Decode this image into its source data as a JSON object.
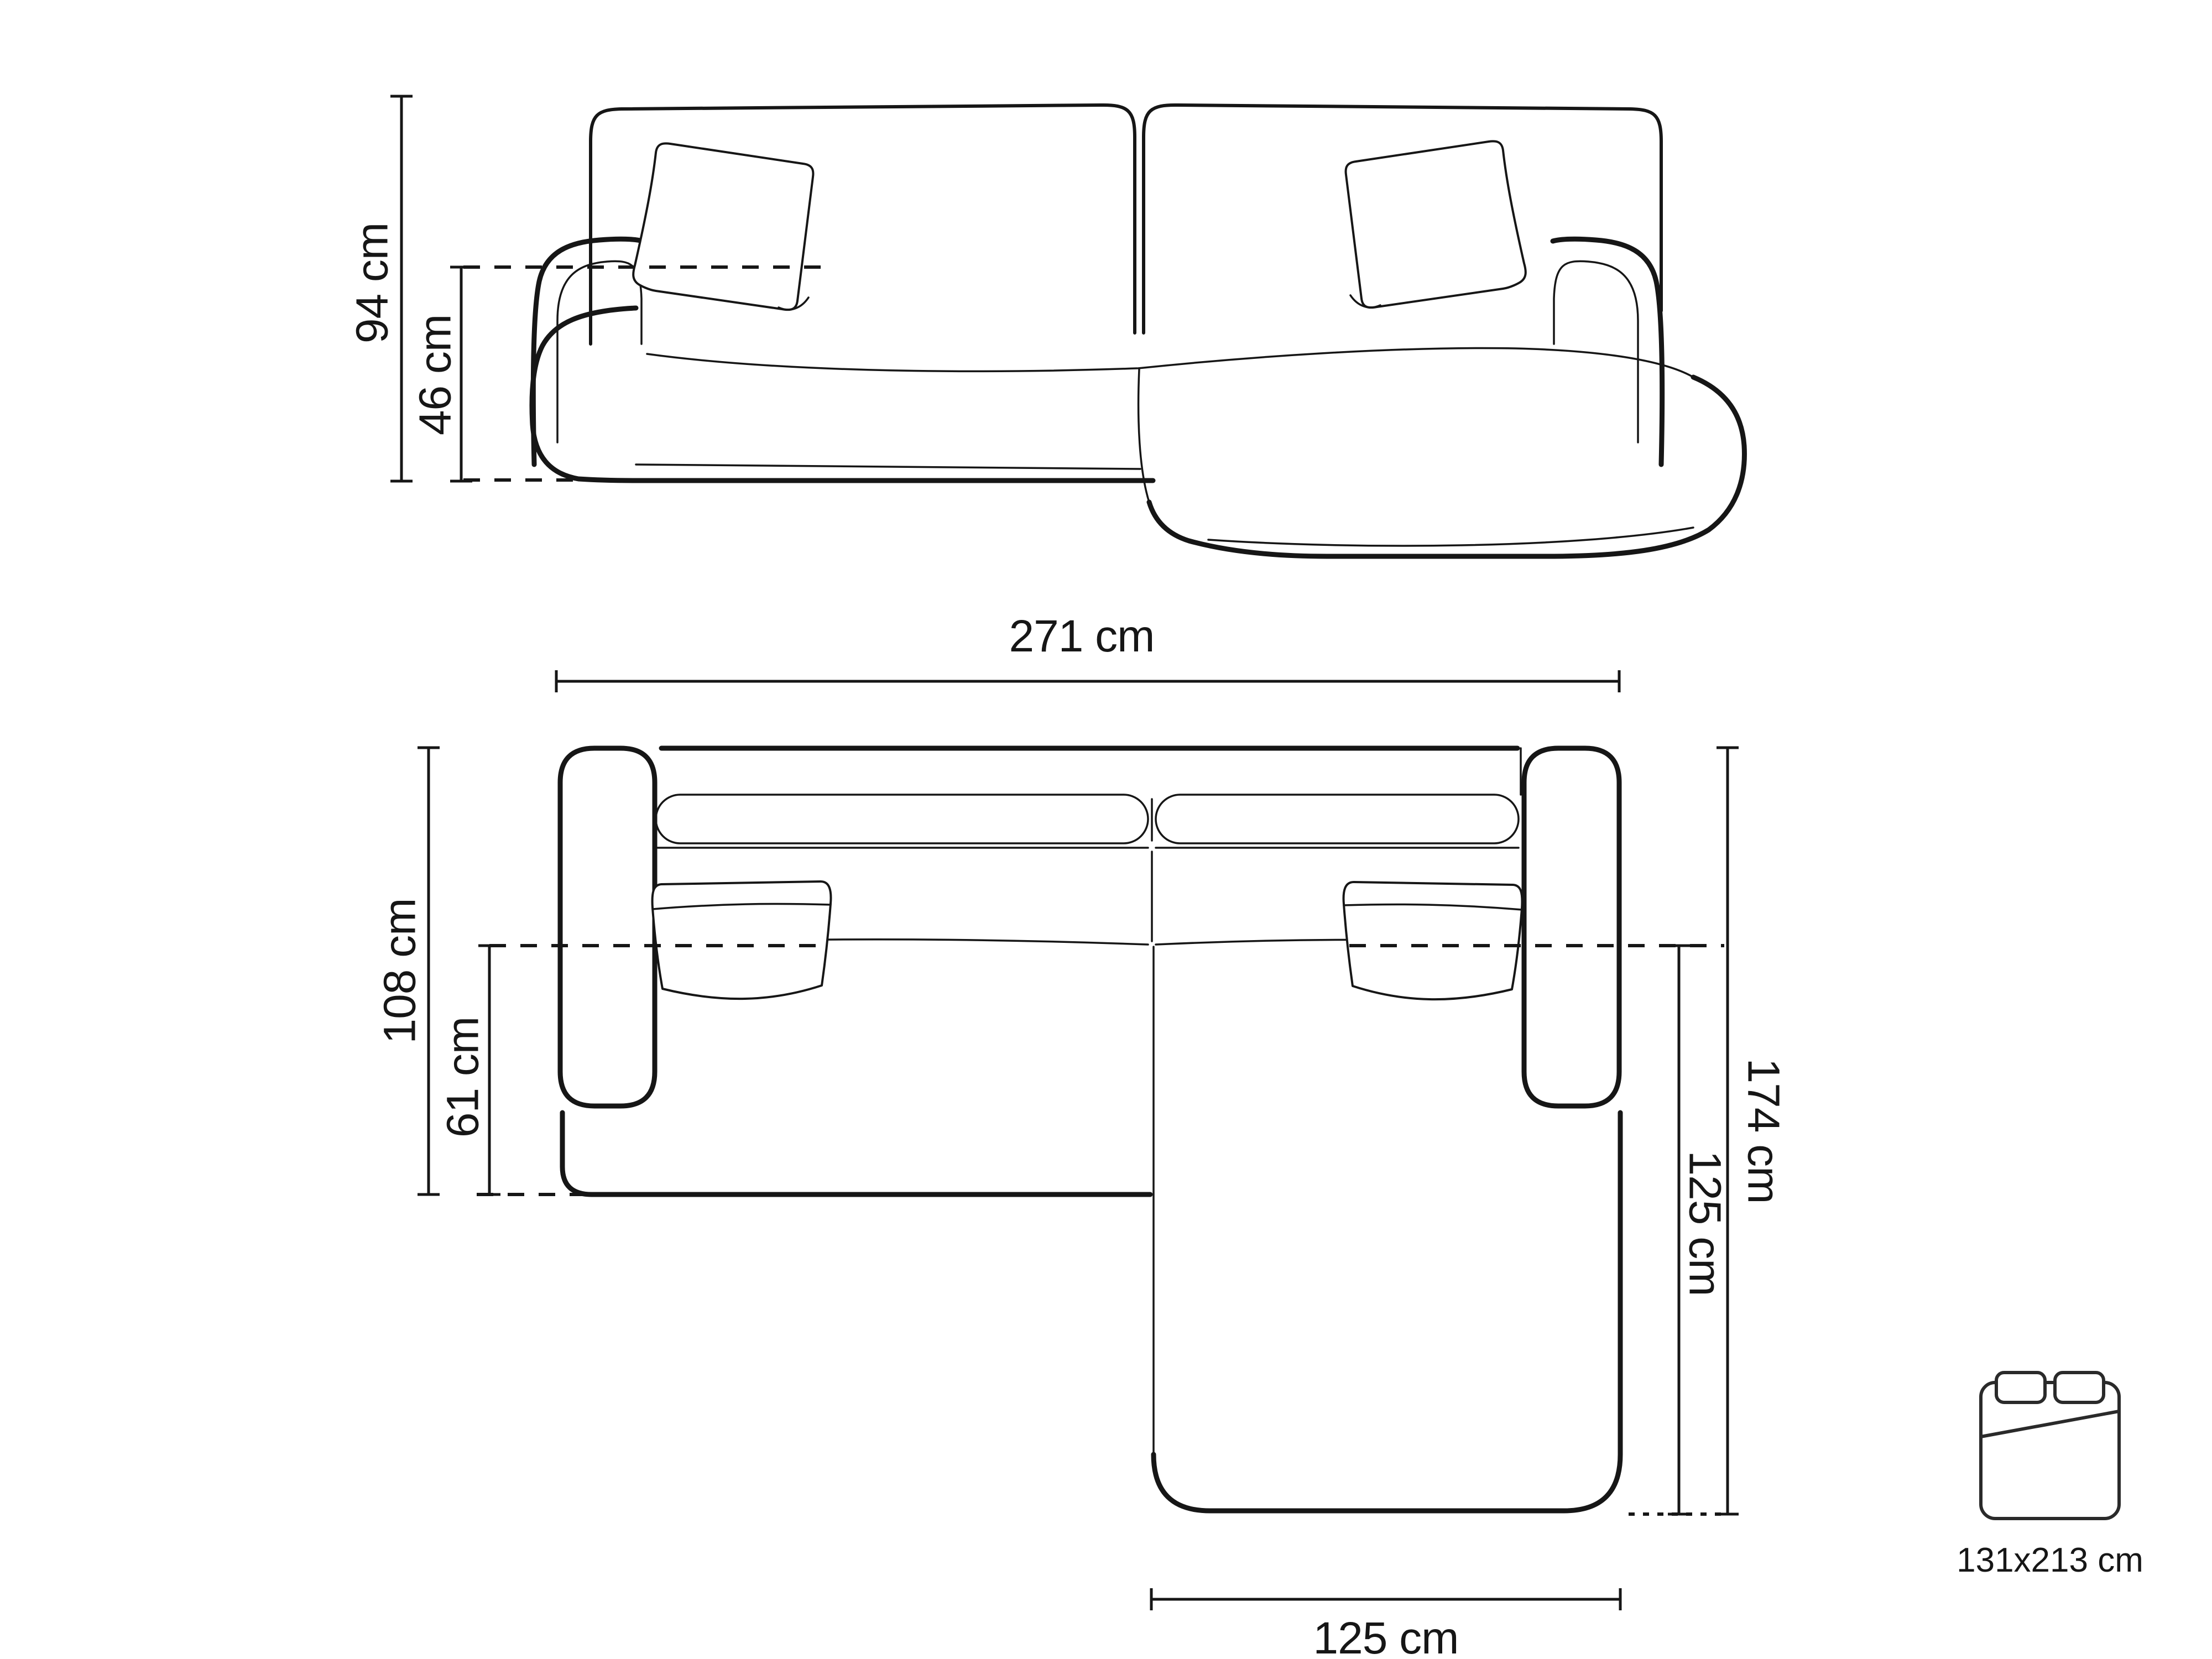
{
  "page": {
    "background_color": "#ffffff",
    "ink_color": "#161616",
    "description": "Corner sofa technical dimension drawing, front view and top view"
  },
  "front_view": {
    "total_height": "94 cm",
    "seat_height": "46 cm"
  },
  "top_view": {
    "total_width": "271 cm",
    "left_section_depth": "108 cm",
    "seat_depth": "61 cm",
    "chaise_total_depth": "174 cm",
    "chaise_inner_length": "125 cm",
    "chaise_width": "125 cm"
  },
  "bed_icon": {
    "icon": "bed-icon",
    "sleeping_area": "131x213 cm"
  }
}
